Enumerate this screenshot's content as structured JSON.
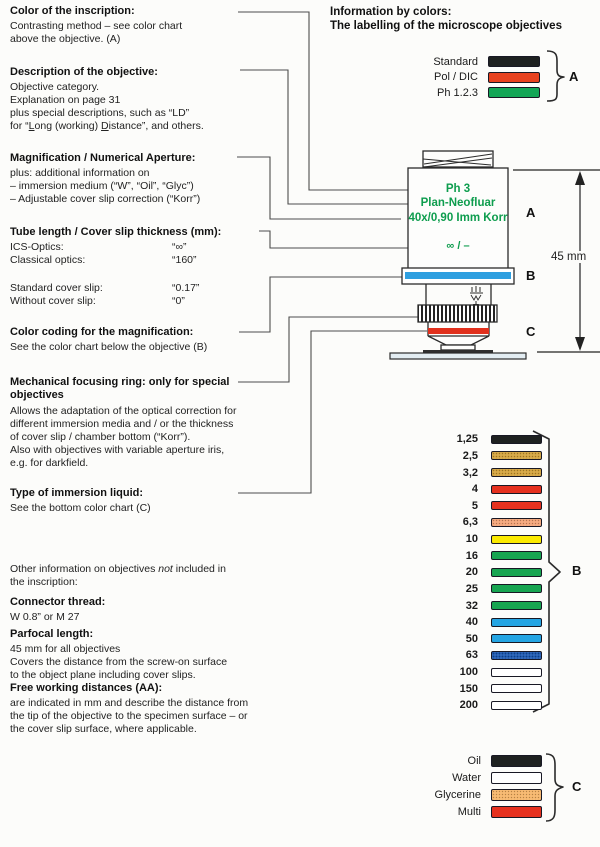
{
  "header": {
    "line1": "Information by colors:",
    "line2": "The labelling of the microscope objectives"
  },
  "blocks": {
    "inscription": {
      "heading": "Color of the inscription:",
      "lines": [
        "Contrasting method – see color chart",
        "above the objective. (A)"
      ]
    },
    "description": {
      "heading": "Description of the objective:",
      "lines": [
        "Objective category.",
        "Explanation on page 31",
        "plus special descriptions, such as “LD”",
        [
          {
            "t": "for “"
          },
          {
            "t": "L",
            "s": "u"
          },
          {
            "t": "ong (working) "
          },
          {
            "t": "D",
            "s": "u"
          },
          {
            "t": "istance”, and others."
          }
        ]
      ]
    },
    "magnification": {
      "heading": "Magnification / Numerical Aperture:",
      "lines": [
        "plus: additional information on",
        "– immersion medium (“W”, “Oil”, “Glyc”)",
        "– Adjustable cover slip correction (“Korr”)"
      ]
    },
    "tube": {
      "heading": "Tube length / Cover slip thickness (mm):",
      "rows1": [
        [
          "ICS-Optics:",
          "“∞”"
        ],
        [
          "Classical optics:",
          "“160”"
        ]
      ],
      "rows2": [
        [
          "Standard cover slip:",
          "“0.17”"
        ],
        [
          "Without cover slip:",
          "“0”"
        ]
      ]
    },
    "colorcoding": {
      "heading": "Color coding for the magnification:",
      "lines": [
        "See the color chart below the objective (B)"
      ]
    },
    "focusring": {
      "heading": "Mechanical focusing ring: only for special objectives",
      "lines": [
        "Allows the adaptation of the optical correction for",
        "different immersion media and / or the thickness",
        "of cover slip / chamber bottom (“Korr”).",
        "Also with objectives with variable aperture iris,",
        "e.g. for darkfield."
      ]
    },
    "immersion": {
      "heading": "Type of immersion liquid:",
      "lines": [
        "See the bottom color chart (C)"
      ]
    },
    "other": {
      "lines": [
        [
          {
            "t": "Other information on objectives "
          },
          {
            "t": "not",
            "s": "i"
          },
          {
            "t": " included in"
          }
        ],
        "the inscription:"
      ]
    },
    "thread": {
      "heading": "Connector thread:",
      "lines": [
        "W 0.8” or M 27"
      ]
    },
    "parfocal": {
      "heading": "Parfocal length:",
      "lines": [
        "45 mm for all objectives",
        "Covers the distance from the screw-on surface",
        "to the object plane including cover slips."
      ]
    },
    "freeworking": {
      "heading": "Free working distances (AA):",
      "lines": [
        "are indicated in mm and describe the distance from",
        "the tip of the objective to the specimen surface – or",
        "the cover slip surface, where applicable."
      ]
    }
  },
  "objective": {
    "label_contrast": "Ph 3",
    "label_name": "Plan-Neofluar",
    "label_mag": "40x/0,90 Imm Korr",
    "label_tube": "∞ / –",
    "zones": [
      "A",
      "B",
      "C"
    ],
    "dimension": "45 mm",
    "text_color": "#0e9d4e",
    "ring_b_color": "#2e9fe0",
    "ring_c_color": "#e1301c"
  },
  "charts": {
    "a": {
      "brace_label": "A",
      "rows": [
        {
          "label": "Standard",
          "color": "#1e2120"
        },
        {
          "label": "Pol / DIC",
          "color": "#e8421f"
        },
        {
          "label": "Ph 1.2.3",
          "color": "#13a656"
        }
      ]
    },
    "b": {
      "brace_label": "B",
      "rows": [
        {
          "label": "1,25",
          "color": "#1e2120"
        },
        {
          "label": "2,5",
          "color": "#d1a13c",
          "textured": true
        },
        {
          "label": "3,2",
          "color": "#d1a13c",
          "textured": true
        },
        {
          "label": "4",
          "color": "#e6311f"
        },
        {
          "label": "5",
          "color": "#e6311f"
        },
        {
          "label": "6,3",
          "color": "#f2a377",
          "textured": true
        },
        {
          "label": "10",
          "color": "#fbea00"
        },
        {
          "label": "16",
          "color": "#17a551"
        },
        {
          "label": "20",
          "color": "#17a551"
        },
        {
          "label": "25",
          "color": "#17a551"
        },
        {
          "label": "32",
          "color": "#17a551"
        },
        {
          "label": "40",
          "color": "#25a5e3"
        },
        {
          "label": "50",
          "color": "#25a5e3"
        },
        {
          "label": "63",
          "color": "#1c57ae",
          "textured": true
        },
        {
          "label": "100",
          "color": "#ffffff"
        },
        {
          "label": "150",
          "color": "#ffffff"
        },
        {
          "label": "200",
          "color": "#ffffff"
        }
      ]
    },
    "c": {
      "brace_label": "C",
      "rows": [
        {
          "label": "Oil",
          "color": "#1e2120"
        },
        {
          "label": "Water",
          "color": "#ffffff"
        },
        {
          "label": "Glycerine",
          "color": "#f4b469",
          "textured": true
        },
        {
          "label": "Multi",
          "color": "#e6311f"
        }
      ]
    }
  }
}
